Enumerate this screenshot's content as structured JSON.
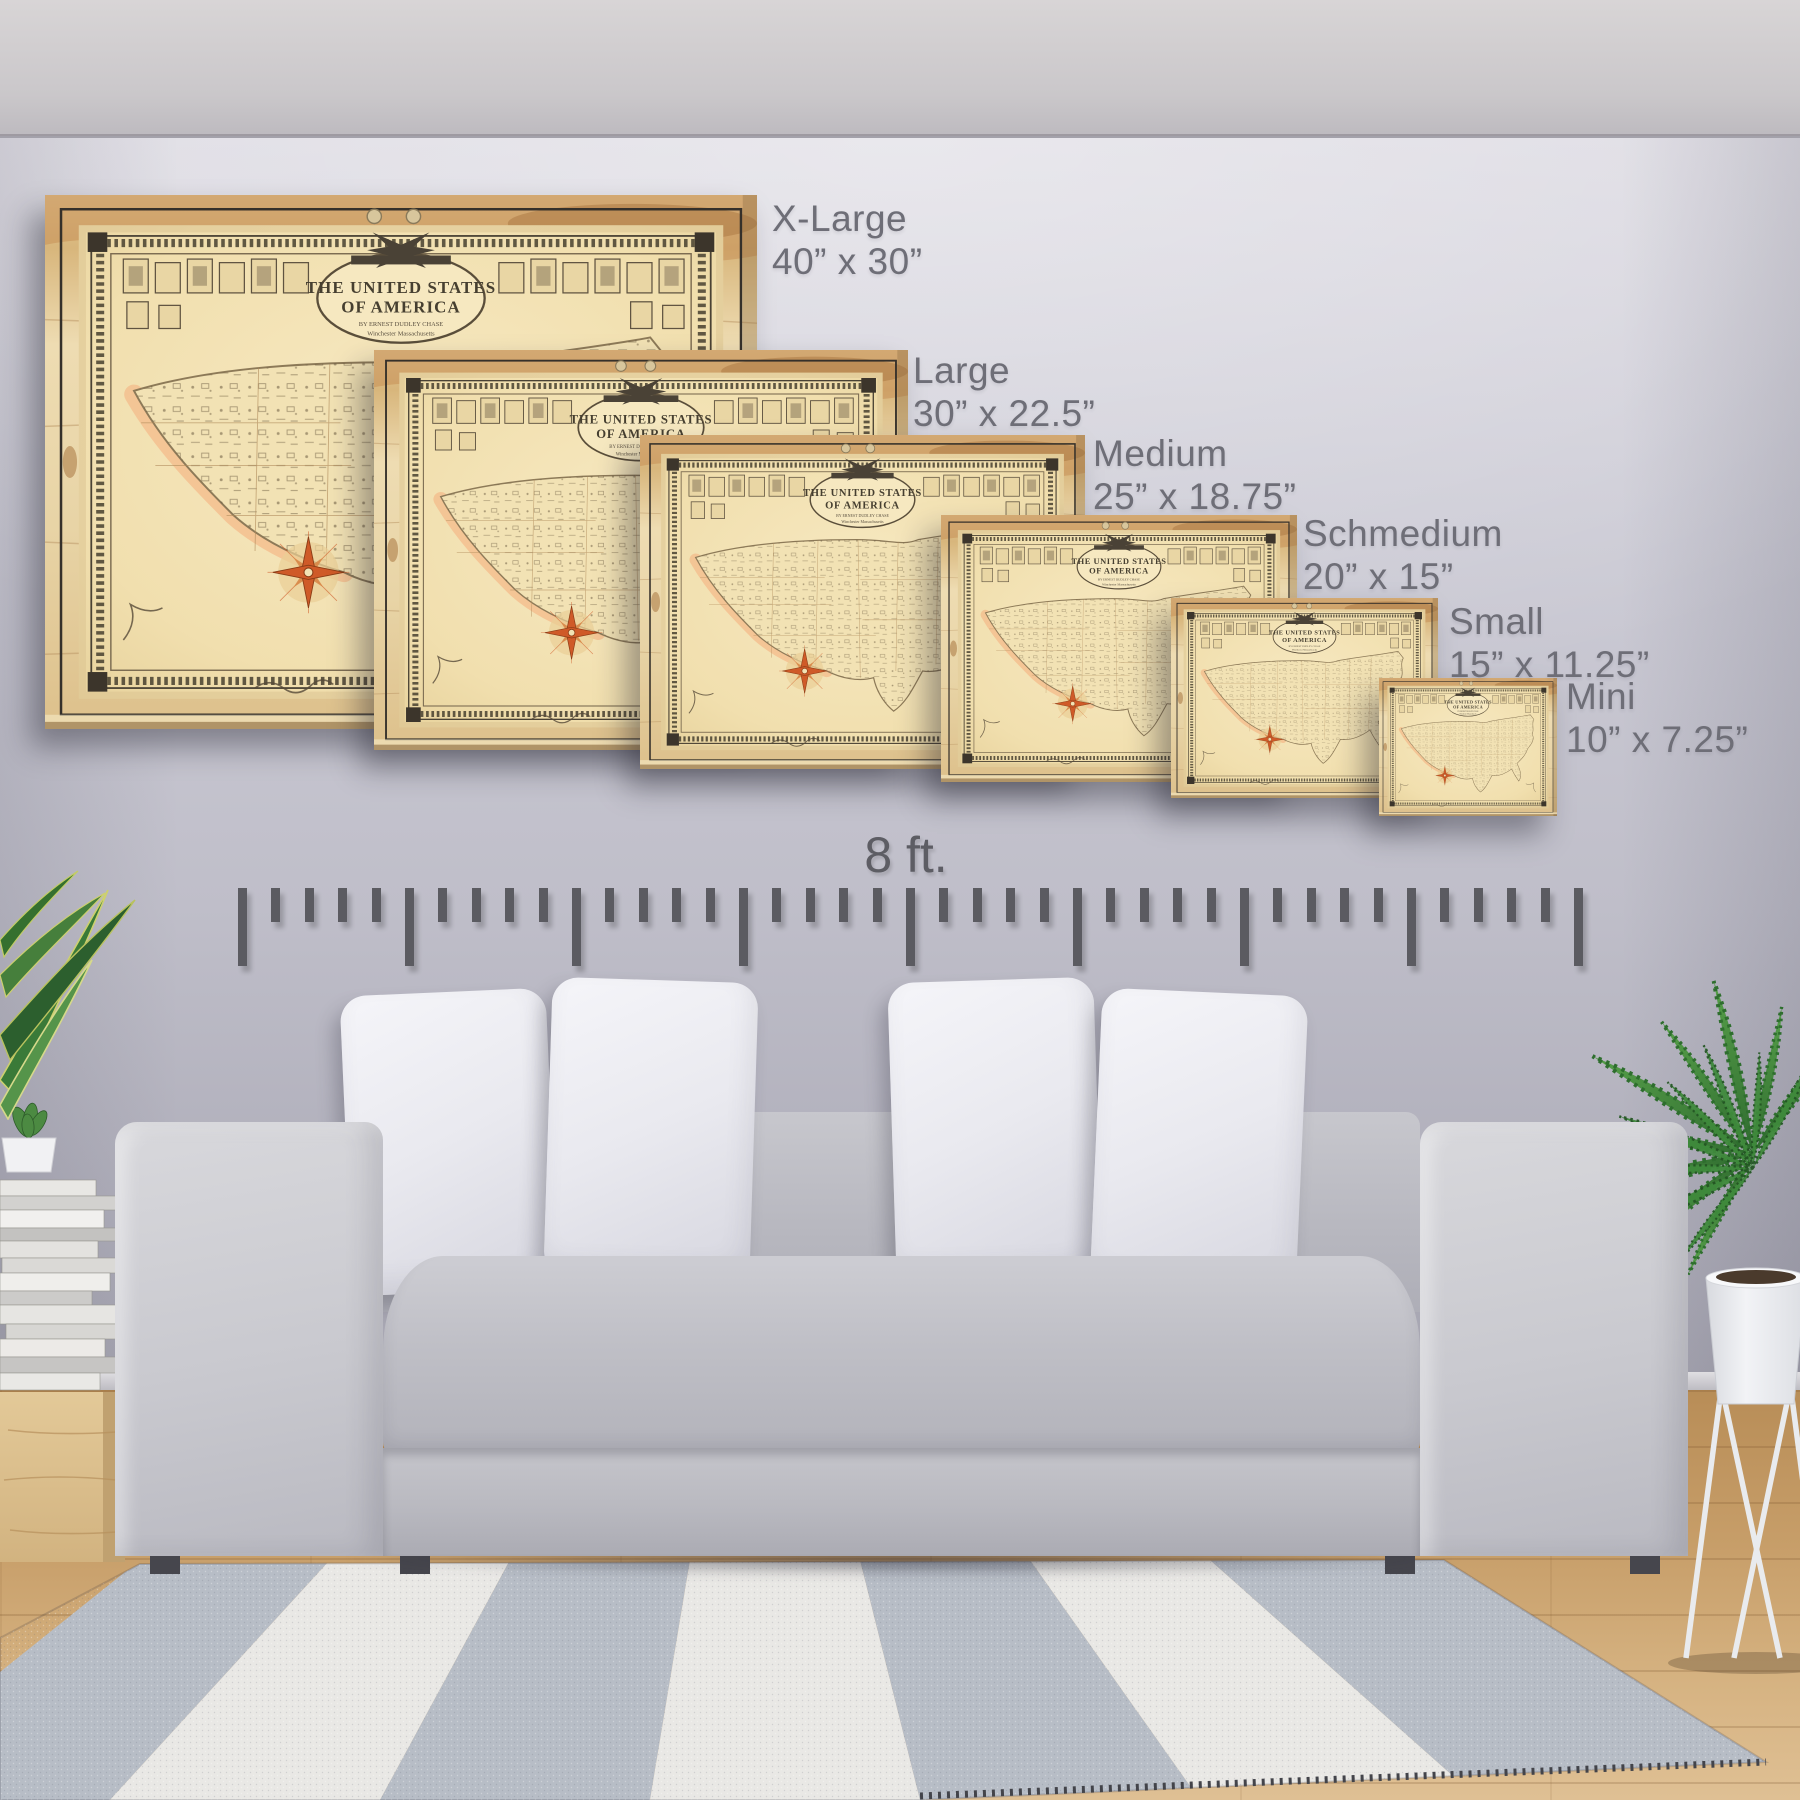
{
  "sizes": [
    {
      "label": "X-Large",
      "dimensions": "40” x 30”"
    },
    {
      "label": "Large",
      "dimensions": "30” x 22.5”"
    },
    {
      "label": "Medium",
      "dimensions": "25” x 18.75”"
    },
    {
      "label": "Schmedium",
      "dimensions": "20” x 15”"
    },
    {
      "label": "Small",
      "dimensions": "15” x 11.25”"
    },
    {
      "label": "Mini",
      "dimensions": "10” x 7.25”"
    }
  ],
  "ruler": {
    "label": "8 ft.",
    "feet": 8,
    "ticks_per_foot": 5
  },
  "map_art": {
    "title_line1": "THE  UNITED  STATES",
    "title_line2": "OF  AMERICA",
    "byline": "BY  ERNEST  DUDLEY  CHASE",
    "subline": "Winchester  Massachusetts"
  },
  "icons": [
    "compass-rose-icon",
    "eagle-crest-icon",
    "ruler-tick",
    "wood-map-panel"
  ],
  "colors": {
    "wall": "#c3c2cc",
    "label_text": "#6e6e77",
    "ruler_tick": "#5b5b61",
    "wood_panel": "#e6d0a0",
    "map_paper": "#f4e5ba",
    "compass_orange": "#cf5a28",
    "couch_gray": "#c5c5cb",
    "pillow_white": "#ededf2",
    "rug_gray": "#b7bdc6",
    "rug_white": "#e9e8e5",
    "floor_wood": "#c79e69"
  }
}
